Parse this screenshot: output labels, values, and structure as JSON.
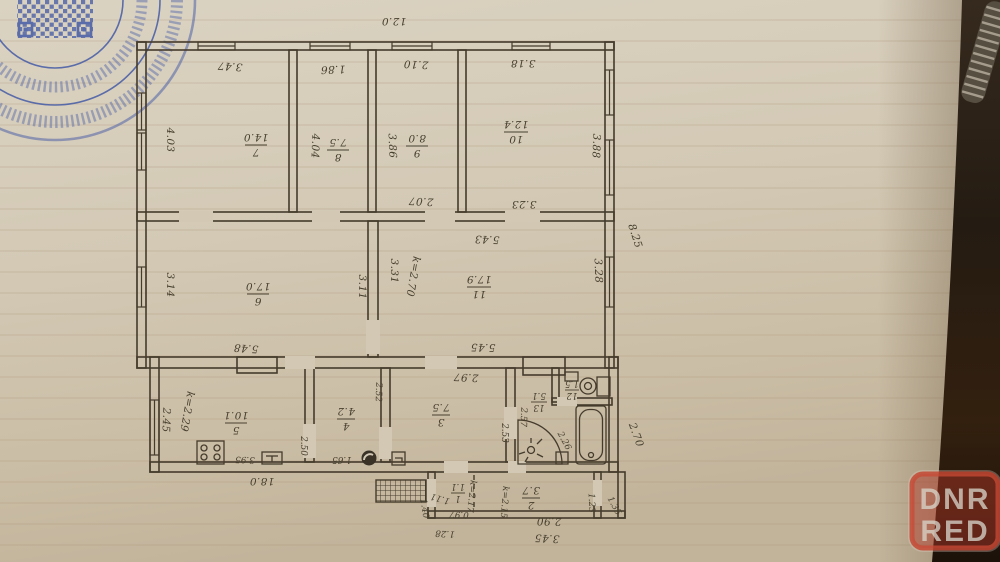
{
  "photo": {
    "paper_color": "#d3c9b6",
    "background_color": "#2e2318",
    "stamp_color": "#3f57a5",
    "watermark": {
      "line1": "DNR",
      "line2": "RED",
      "color": "#c24434"
    }
  },
  "plan": {
    "overall": {
      "top_width": "12.0",
      "right_height": "8.25",
      "bottom_width": "18.0",
      "right_lower": "2.70",
      "porch_bottom": "3.45",
      "porch_right_inner": "1.23",
      "porch_right_outer": "1.35",
      "porch_left_height": "1.40",
      "porch_left_width": "1.28",
      "r1_bottom": "0.97"
    },
    "rooms": {
      "r1": {
        "num": "1",
        "area": "1.1",
        "height": "k=2.17",
        "w": "1.11"
      },
      "r2": {
        "num": "2",
        "area": "3.7",
        "height": "k=2.15",
        "b": "2.90"
      },
      "r3": {
        "num": "3",
        "area": "7.5",
        "t": "2.97",
        "l": "2.53",
        "r": "2.57"
      },
      "r4": {
        "num": "4",
        "area": "4.2",
        "r": "2.52",
        "b": "1.65"
      },
      "r5": {
        "num": "5",
        "area": "10.1",
        "height": "k=2.29",
        "l": "2.45",
        "b": "3.95",
        "r": "2.50"
      },
      "r6": {
        "num": "6",
        "area": "17.0",
        "l": "3.14",
        "r": "3.11",
        "b": "5.48"
      },
      "r7": {
        "num": "7",
        "area": "14.0",
        "t": "3.47",
        "l": "4.03"
      },
      "r8": {
        "num": "8",
        "area": "7.5",
        "t": "1.86",
        "l": "4.04"
      },
      "r9": {
        "num": "9",
        "area": "8.0",
        "t": "2.10",
        "l": "3.86",
        "b": "2.07"
      },
      "r10": {
        "num": "10",
        "area": "12.4",
        "t": "3.18",
        "r": "3.88",
        "b": "3.23"
      },
      "r11": {
        "num": "11",
        "area": "17.9",
        "height": "k=2.70",
        "t": "5.43",
        "b": "5.45",
        "l": "3.31",
        "r": "3.28"
      },
      "r12": {
        "num": "12",
        "area": "1.5"
      },
      "r13": {
        "num": "13",
        "area": "5.1",
        "r": "2.26"
      }
    }
  }
}
